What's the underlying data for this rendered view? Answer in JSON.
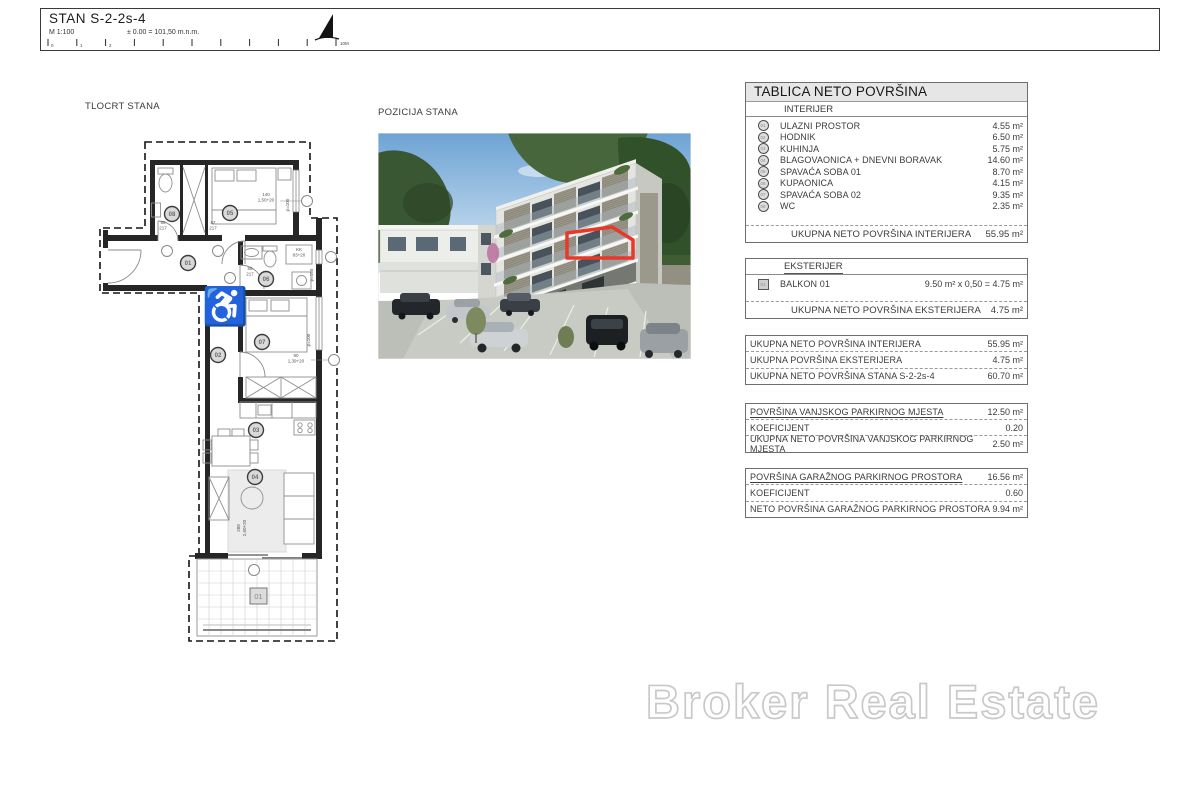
{
  "titleblock": {
    "title": "STAN  S-2-2s-4",
    "scale": "M 1:100",
    "elevation": "± 0.00 = 101,50 m.n.m.",
    "ticks": {
      "t0": "0",
      "t1": "1",
      "t2": "2",
      "end": "10M"
    }
  },
  "labels": {
    "floorplan": "TLOCRT STANA",
    "position": "POZICIJA STANA"
  },
  "floorplan": {
    "wheelchair_icon": "♿",
    "rooms": {
      "entry": "01",
      "hall": "02",
      "kitchen": "03",
      "living": "04",
      "bedroom1": "05",
      "bathroom": "06",
      "bedroom2": "07",
      "wc": "08"
    },
    "balcony_tag": "01",
    "dims": {
      "bed1": "140",
      "bed1b": "1,50+20",
      "bed1p": "p=100",
      "door1": "85",
      "door1b": "217",
      "door2": "82",
      "door2b": "217",
      "bathdoor": "85",
      "bathdoorb": "217",
      "bath": "KK",
      "bathb": "83+20",
      "bathp": "p=150",
      "bed2": "90",
      "bed2b": "1,39+20",
      "bed2p": "p=100",
      "balc": "288",
      "balcb": "2,60+20"
    }
  },
  "photo": {
    "highlight": "#e8382a"
  },
  "tables": {
    "main": {
      "title": "TABLICA NETO POVRŠINA",
      "section": "INTERIJER",
      "rows": [
        {
          "n": "01",
          "label": "ULAZNI PROSTOR",
          "value": "4.55 m²"
        },
        {
          "n": "02",
          "label": "HODNIK",
          "value": "6.50 m²"
        },
        {
          "n": "03",
          "label": "KUHINJA",
          "value": "5.75 m²"
        },
        {
          "n": "04",
          "label": "BLAGOVAONICA + DNEVNI BORAVAK",
          "value": "14.60 m²"
        },
        {
          "n": "05",
          "label": "SPAVAĆA SOBA 01",
          "value": "8.70 m²"
        },
        {
          "n": "06",
          "label": "KUPAONICA",
          "value": "4.15 m²"
        },
        {
          "n": "07",
          "label": "SPAVAĆA SOBA 02",
          "value": "9.35 m²"
        },
        {
          "n": "08",
          "label": "WC",
          "value": "2.35 m²"
        }
      ],
      "total_label": "UKUPNA NETO POVRŠINA INTERIJERA",
      "total_value": "55.95 m²"
    },
    "ext": {
      "section": "EKSTERIJER",
      "row": {
        "n": "01",
        "label": "BALKON 01",
        "value": "9.50 m²  x 0,50 =  4.75 m²"
      },
      "total_label": "UKUPNA NETO POVRŠINA EKSTERIJERA",
      "total_value": "4.75 m²"
    },
    "sum": {
      "rows": [
        {
          "label": "UKUPNA NETO POVRŠINA INTERIJERA",
          "value": "55.95 m²"
        },
        {
          "label": "UKUPNA POVRŠINA EKSTERIJERA",
          "value": "4.75 m²"
        },
        {
          "label": "UKUPNA NETO POVRŠINA STANA S-2-2s-4",
          "value": "60.70 m²"
        }
      ]
    },
    "park": {
      "rows": [
        {
          "label": "POVRŠINA VANJSKOG PARKIRNOG MJESTA",
          "value": "12.50 m²"
        },
        {
          "label": "KOEFICIJENT",
          "value": "0.20"
        },
        {
          "label": "UKUPNA NETO POVRŠINA VANJSKOG PARKIRNOG MJESTA",
          "value": "2.50 m²"
        }
      ]
    },
    "gar": {
      "rows": [
        {
          "label": "POVRŠINA GARAŽNOG PARKIRNOG PROSTORA",
          "value": "16.56 m²"
        },
        {
          "label": "KOEFICIJENT",
          "value": "0.60"
        },
        {
          "label": "NETO POVRŠINA GARAŽNOG PARKIRNOG PROSTORA",
          "value": "9.94 m²"
        }
      ]
    }
  },
  "watermark": {
    "text": "Broker Real Estate"
  }
}
